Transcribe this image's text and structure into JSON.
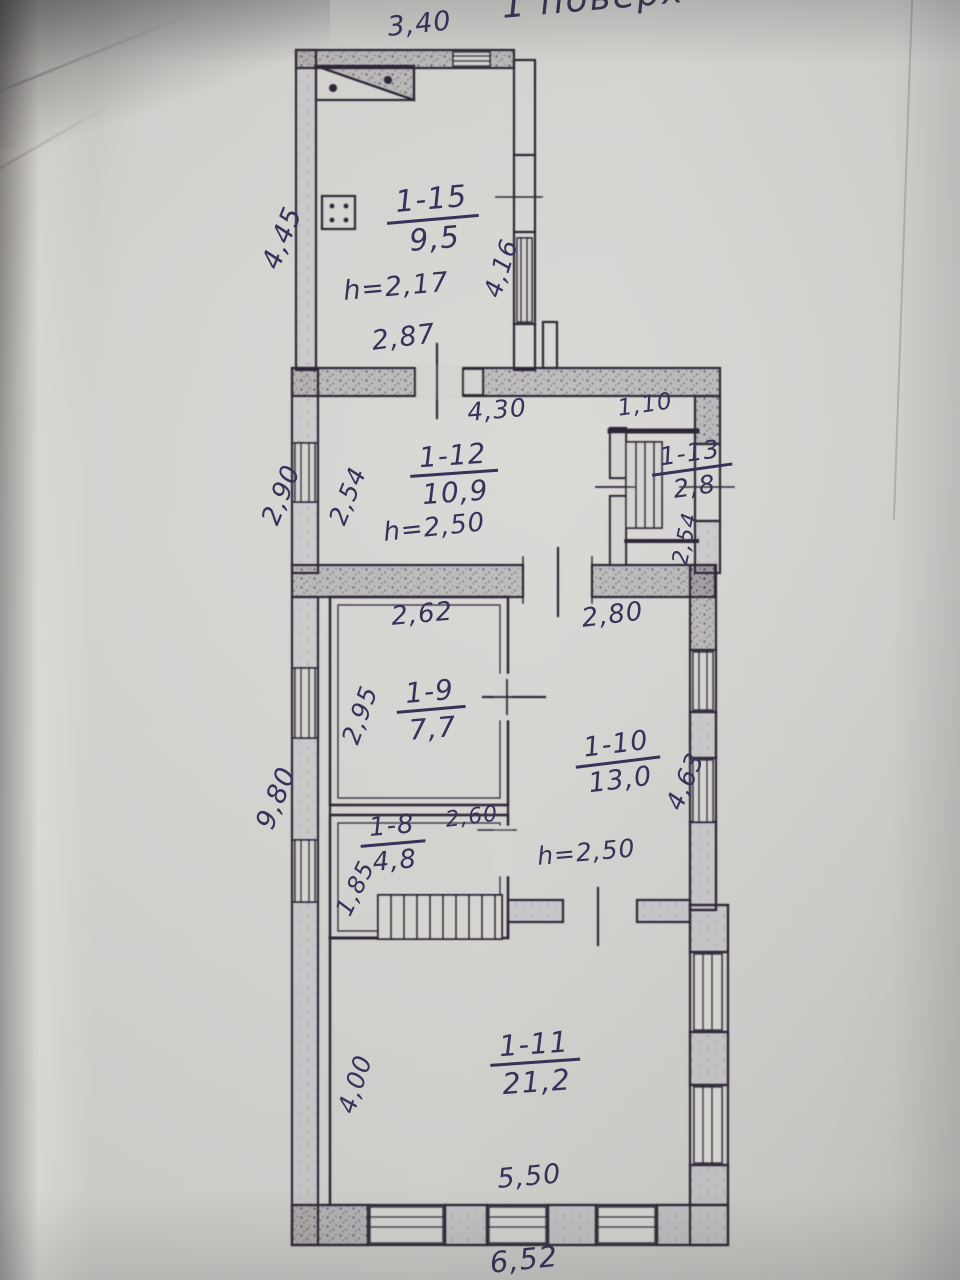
{
  "document": {
    "title": "1 поверх"
  },
  "colors": {
    "paper": "#d7d5d2",
    "plan_ink": "#2f2838",
    "pen_ink": "#38315a"
  },
  "rooms": [
    {
      "id": "1-15",
      "area": "9,5",
      "height": "h=2,17"
    },
    {
      "id": "1-12",
      "area": "10,9",
      "height": "h=2,50"
    },
    {
      "id": "1-13",
      "area": "2,8"
    },
    {
      "id": "1-9",
      "area": "7,7"
    },
    {
      "id": "1-10",
      "area": "13,0",
      "height": "h=2,50"
    },
    {
      "id": "1-8",
      "area": "4,8"
    },
    {
      "id": "1-11",
      "area": "21,2"
    }
  ],
  "dimensions": {
    "top_1_15": "3,40",
    "left_1_15": "4,45",
    "right_1_15": "4,16",
    "bottom_1_15": "2,87",
    "top_1_12": "4,30",
    "top_1_13": "1,10",
    "left_outer_1_12": "2,90",
    "left_1_12": "2,54",
    "right_1_13": "2,54",
    "top_1_9": "2,62",
    "top_1_10": "2,80",
    "left_1_9": "2,95",
    "right_1_10": "4,63",
    "top_1_8": "2,60",
    "left_1_8": "1,85",
    "left_outer_lower": "9,80",
    "left_1_11": "4,00",
    "bottom_1_11": "5,50",
    "bottom_outer": "6,52"
  }
}
